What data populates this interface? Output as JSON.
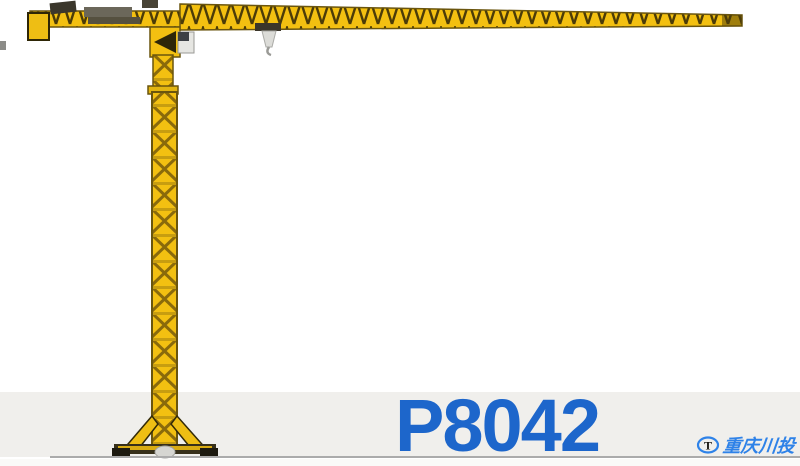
{
  "product": {
    "model": "P8042"
  },
  "branding": {
    "logo_letter": "T",
    "logo_text": "重庆川投"
  },
  "colors": {
    "model_text_blue": "#1d66cb",
    "logo_blue": "#2e82e8",
    "crane_yellow": "#f3c011",
    "crane_lattice_dark": "#4c3c08",
    "floor_band_grey": "#f0efec",
    "ground_line_grey": "#ababab",
    "background": "#ffffff"
  },
  "illustration": {
    "subject": "flat-top tower crane",
    "parts": [
      "counterweight",
      "counter-jib",
      "hoist-machinery",
      "turret",
      "operator-cab",
      "main-jib",
      "jib-tip",
      "trolley",
      "hook-block",
      "mast",
      "base-legs",
      "base-platform"
    ]
  }
}
